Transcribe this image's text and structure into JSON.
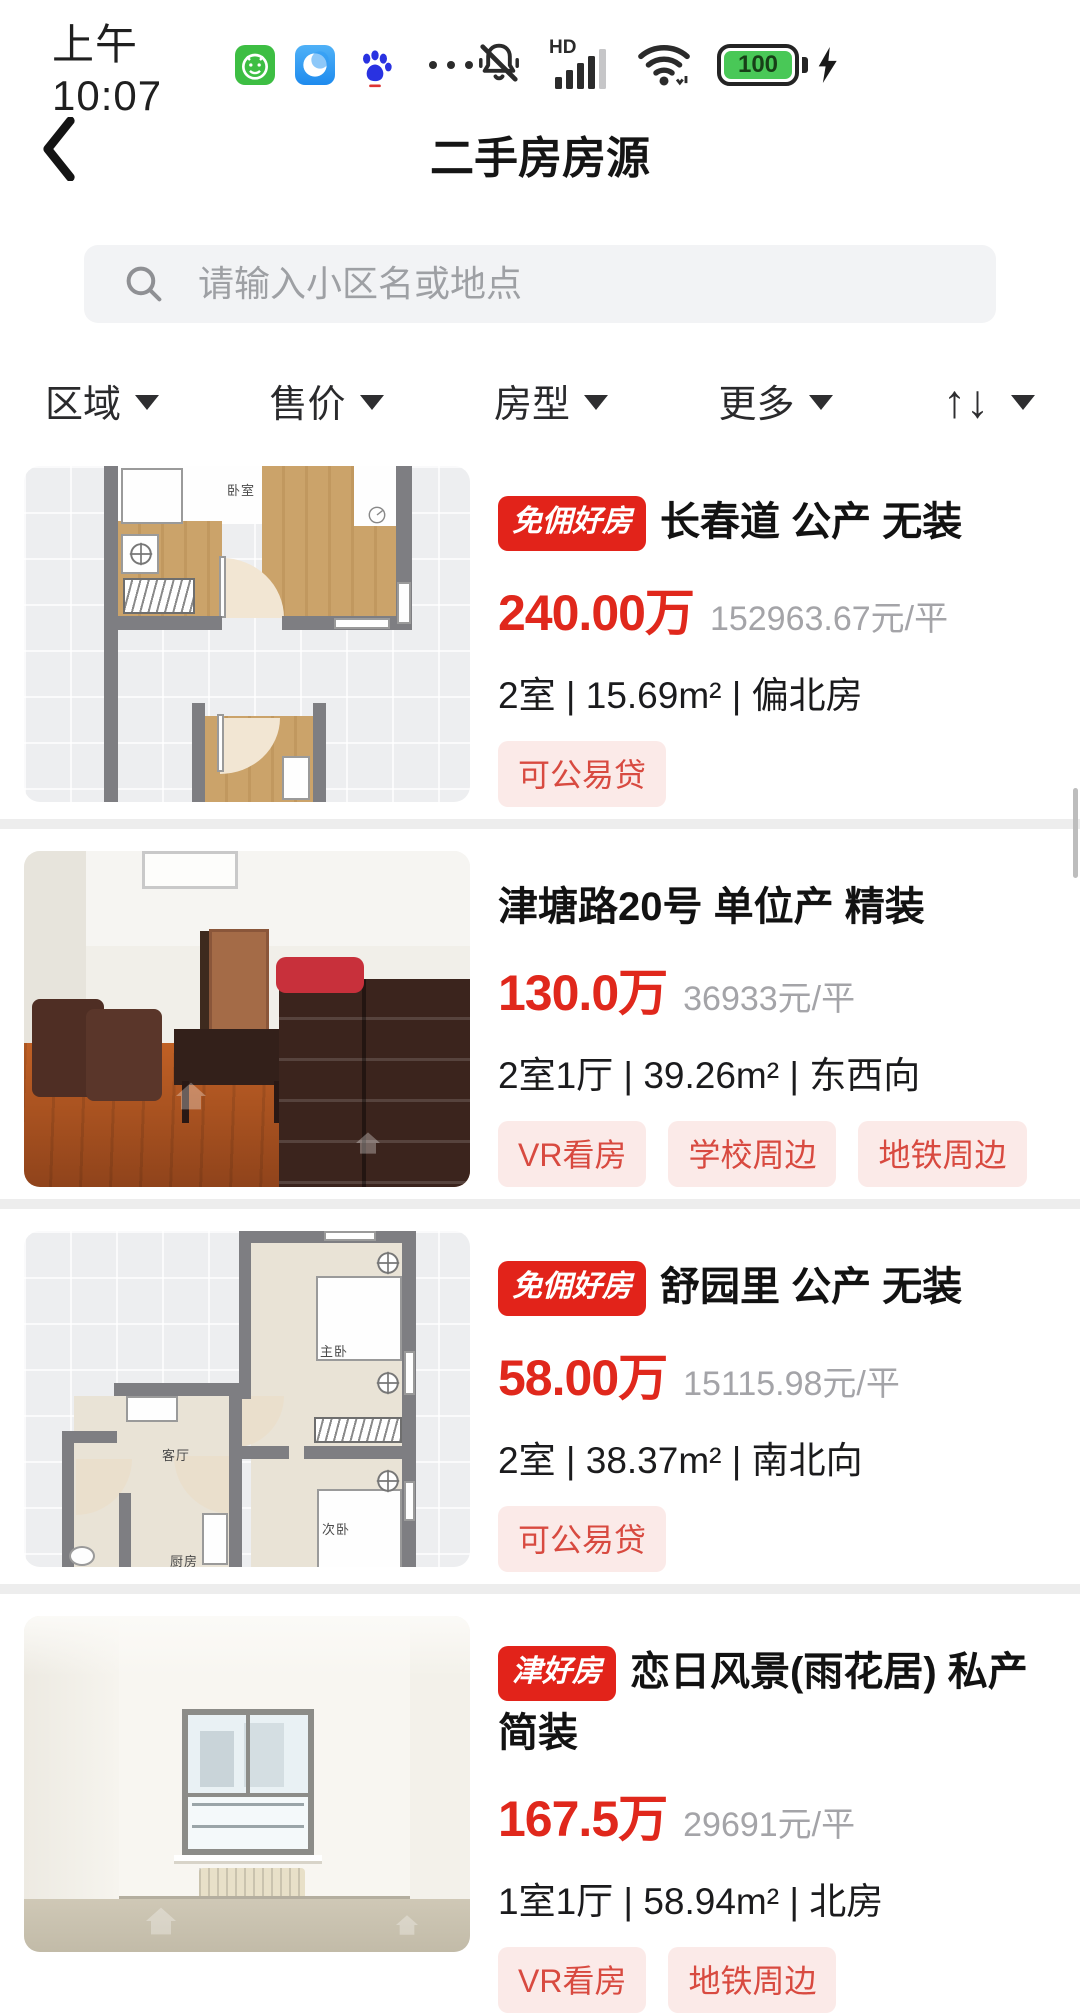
{
  "status_bar": {
    "time": "上午10:07",
    "hd": "HD",
    "battery": "100"
  },
  "nav": {
    "title": "二手房房源"
  },
  "search": {
    "placeholder": "请输入小区名或地点"
  },
  "filter_bar": {
    "filters": [
      "区域",
      "售价",
      "房型",
      "更多"
    ],
    "sort_up": "↑",
    "sort_down": "↓"
  },
  "listings": [
    {
      "badge": "免佣好房",
      "title": "长春道 公产 无装",
      "price": "240.00万",
      "unit_price": "152963.67元/平",
      "specs": "2室 | 15.69m² | 偏北房",
      "tags": [
        "可公易贷"
      ],
      "image_type": "floorplan",
      "room_labels": [
        "卧室"
      ]
    },
    {
      "title": "津塘路20号 单位产 精装",
      "price": "130.0万",
      "unit_price": "36933元/平",
      "specs": "2室1厅 | 39.26m² | 东西向",
      "tags": [
        "VR看房",
        "学校周边",
        "地铁周边"
      ],
      "image_type": "photo"
    },
    {
      "badge": "免佣好房",
      "title": "舒园里 公产 无装",
      "price": "58.00万",
      "unit_price": "15115.98元/平",
      "specs": "2室 | 38.37m² | 南北向",
      "tags": [
        "可公易贷"
      ],
      "image_type": "floorplan",
      "room_labels": [
        "主卧",
        "客厅",
        "厨房",
        "次卧"
      ]
    },
    {
      "badge": "津好房",
      "title": "恋日风景(雨花居) 私产 简装",
      "price": "167.5万",
      "unit_price": "29691元/平",
      "specs": "1室1厅 | 58.94m² | 北房",
      "tags": [
        "VR看房",
        "地铁周边"
      ],
      "image_type": "photo"
    }
  ],
  "colors": {
    "accent_red": "#E0281C",
    "badge_red": "#E2231A",
    "tag_bg": "#FBEAE8",
    "tag_text": "#D84A40",
    "battery_green": "#49C857",
    "search_bg": "#F2F3F5"
  }
}
